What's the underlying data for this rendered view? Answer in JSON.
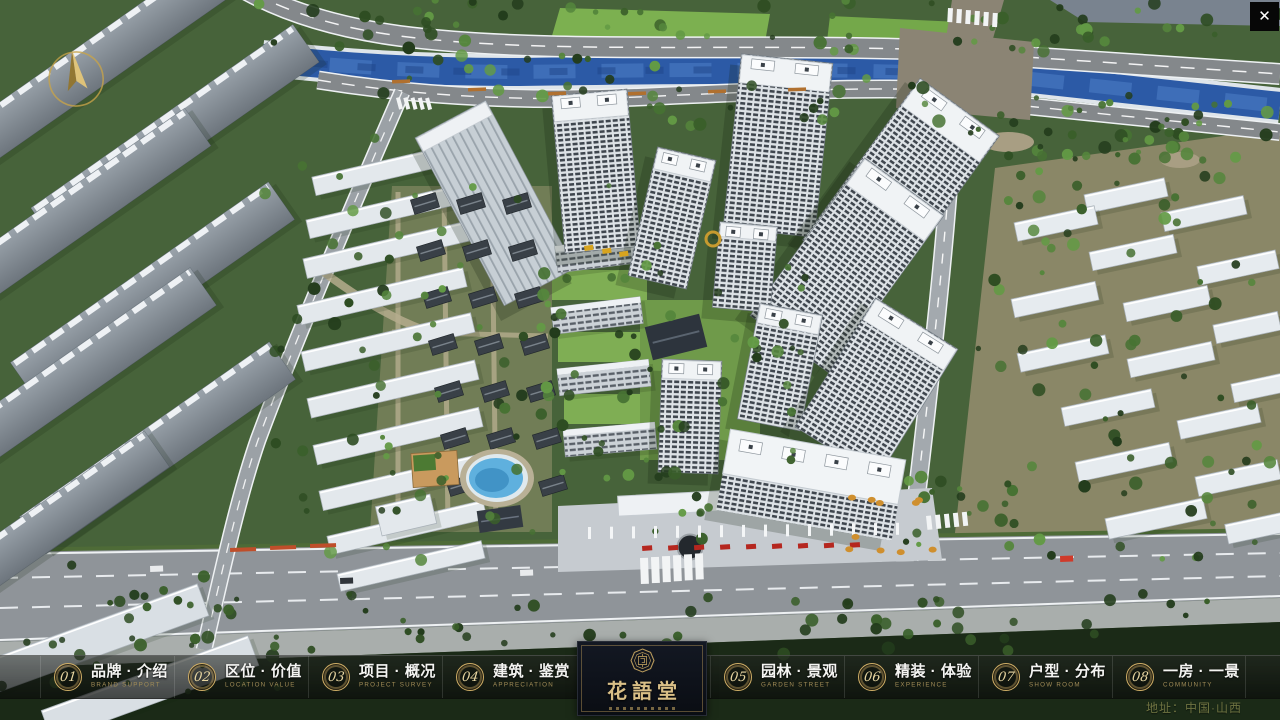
{
  "window": {
    "close_label": "✕"
  },
  "logo": {
    "title": "花語堂"
  },
  "nav": {
    "items": [
      {
        "num": "01",
        "label": "品牌 · 介绍",
        "sub": "BRAND SUPPORT"
      },
      {
        "num": "02",
        "label": "区位 · 价值",
        "sub": "LOCATION VALUE"
      },
      {
        "num": "03",
        "label": "项目 · 概况",
        "sub": "PROJECT SURVEY"
      },
      {
        "num": "04",
        "label": "建筑 · 鉴赏",
        "sub": "APPRECIATION"
      },
      {
        "num": "05",
        "label": "园林 · 景观",
        "sub": "GARDEN STREET"
      },
      {
        "num": "06",
        "label": "精装 · 体验",
        "sub": "EXPERIENCE"
      },
      {
        "num": "07",
        "label": "户型 · 分布",
        "sub": "SHOW ROOM"
      },
      {
        "num": "08",
        "label": "一房 · 一景",
        "sub": "COMMUNITY"
      }
    ]
  },
  "footer": {
    "address": "地址：中国·山西"
  }
}
